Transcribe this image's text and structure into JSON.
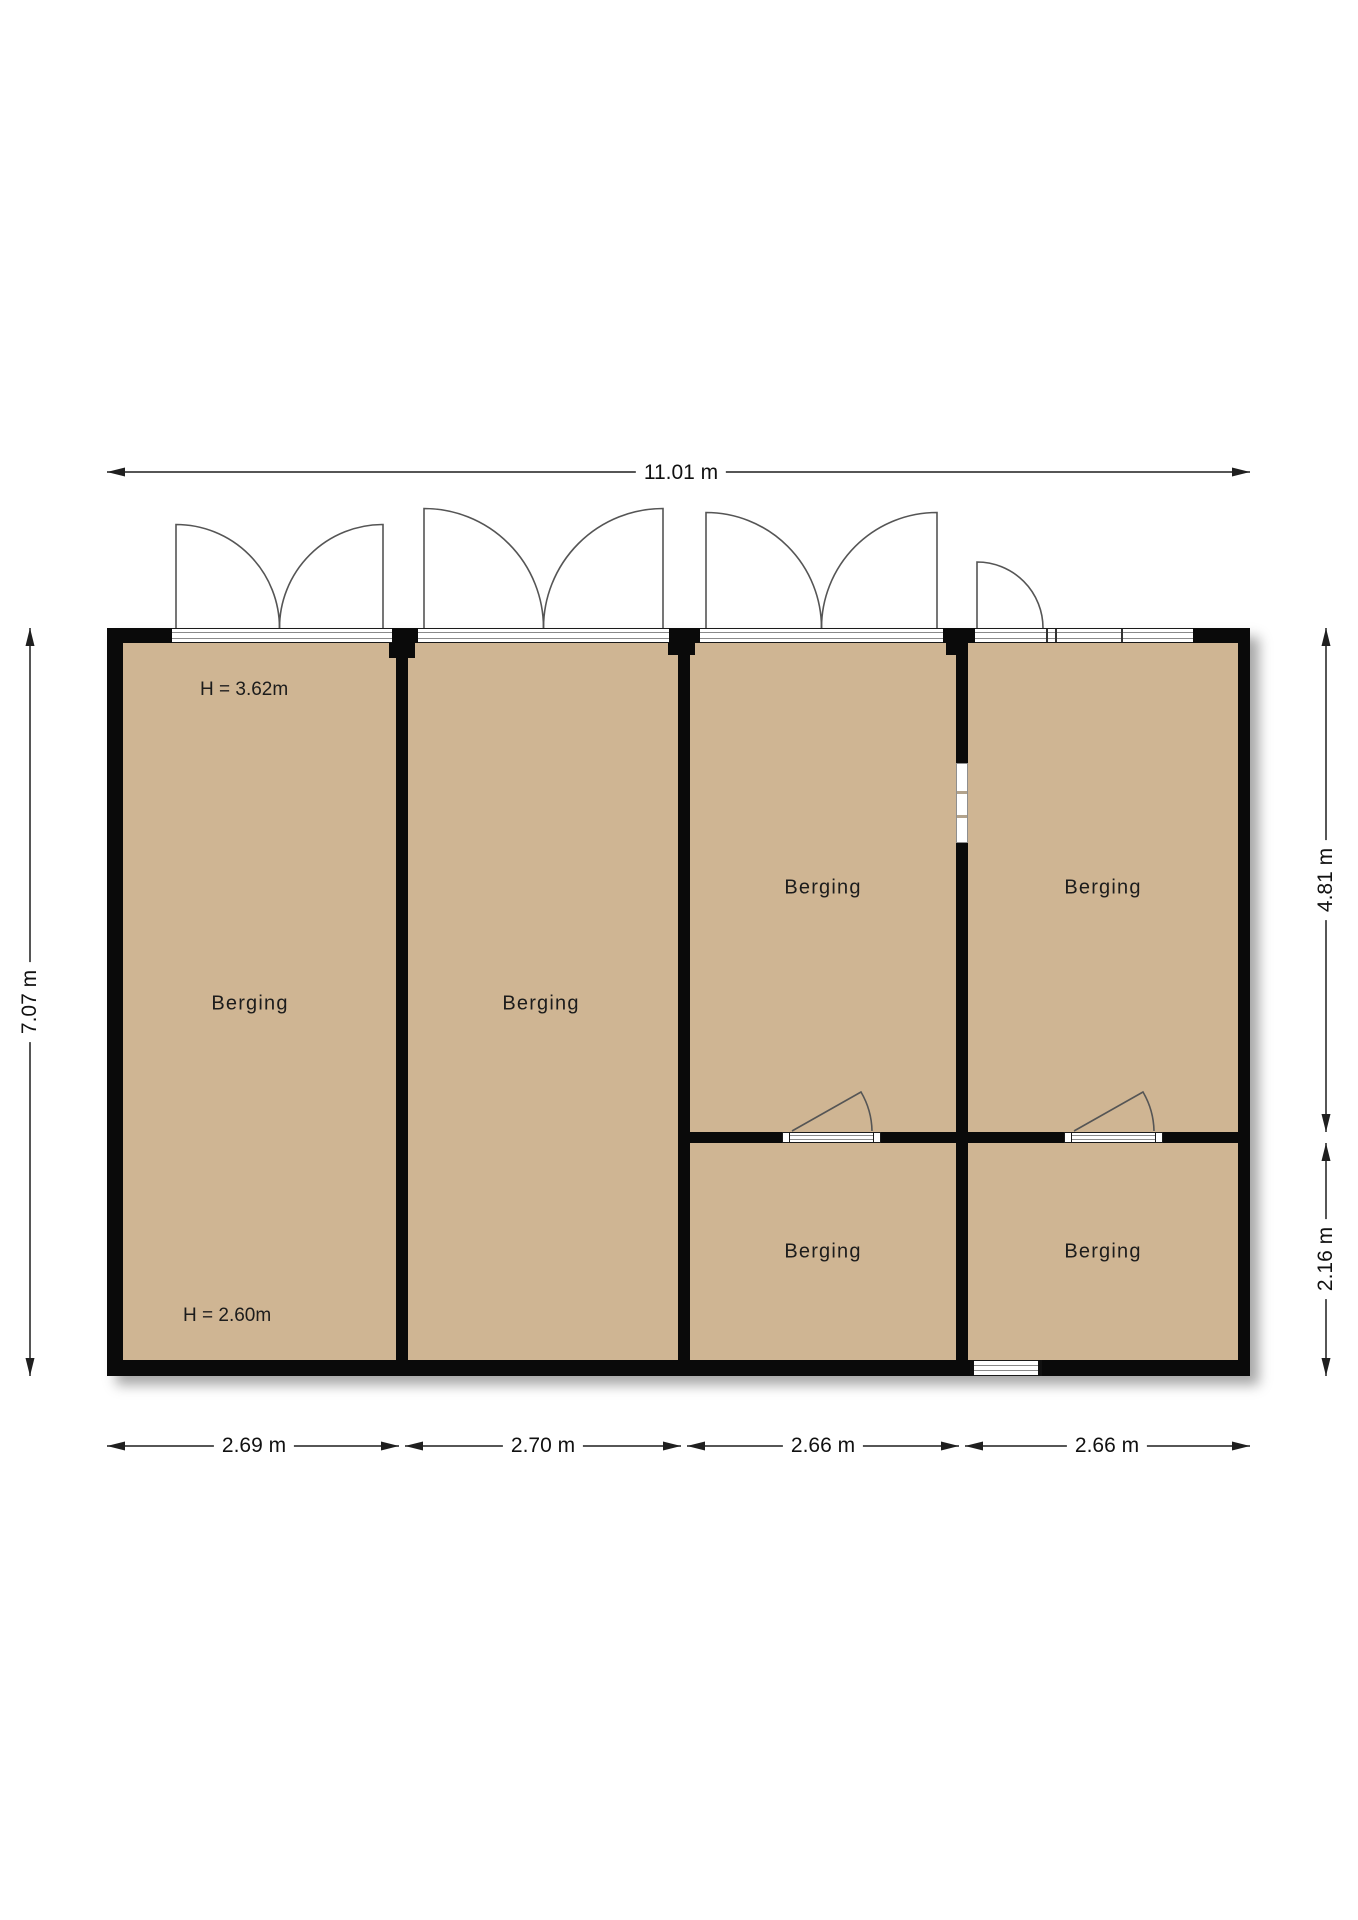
{
  "diagram_type": "floor-plan",
  "rooms": [
    {
      "id": "room-1",
      "label": "Berging"
    },
    {
      "id": "room-2",
      "label": "Berging"
    },
    {
      "id": "room-3",
      "label": "Berging"
    },
    {
      "id": "room-4",
      "label": "Berging"
    },
    {
      "id": "room-5",
      "label": "Berging"
    },
    {
      "id": "room-6",
      "label": "Berging"
    }
  ],
  "height_annotations": {
    "upper": "H = 3.62m",
    "lower": "H = 2.60m"
  },
  "dimensions": {
    "top_total": "11.01 m",
    "left_total": "7.07 m",
    "right_upper": "4.81 m",
    "right_lower": "2.16 m",
    "bottom_widths": [
      "2.69 m",
      "2.70 m",
      "2.66 m",
      "2.66 m"
    ]
  },
  "colors": {
    "floor_fill": "#cfb593",
    "wall": "#0a0a0a",
    "dimension_line": "#1f1f1f",
    "door_line": "#555555",
    "background": "#ffffff"
  }
}
